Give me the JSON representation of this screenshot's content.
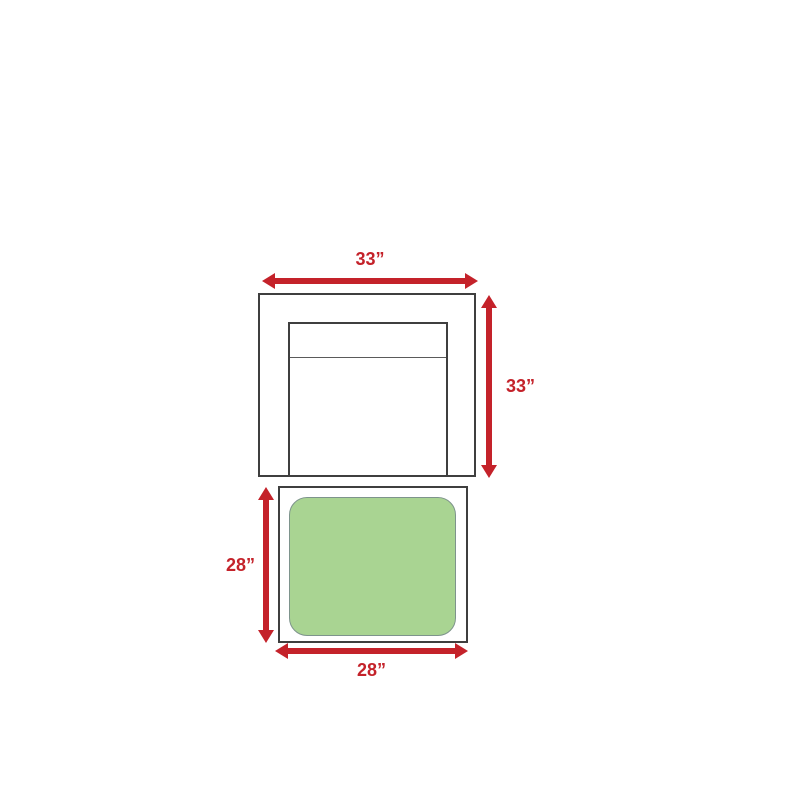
{
  "diagram": {
    "description": "Top-view furniture dimension diagram showing a chair and an ottoman",
    "chair": {
      "width_label": "33”",
      "height_label": "33”",
      "width_in": 33,
      "height_in": 33
    },
    "ottoman": {
      "width_label": "28”",
      "height_label": "28”",
      "width_in": 28,
      "height_in": 28
    },
    "colors": {
      "dimension": "#c4222a",
      "outline": "#3f3f3f",
      "cushion_fill": "#a9d492",
      "cushion_border": "#7e948c",
      "background": "#ffffff"
    }
  }
}
